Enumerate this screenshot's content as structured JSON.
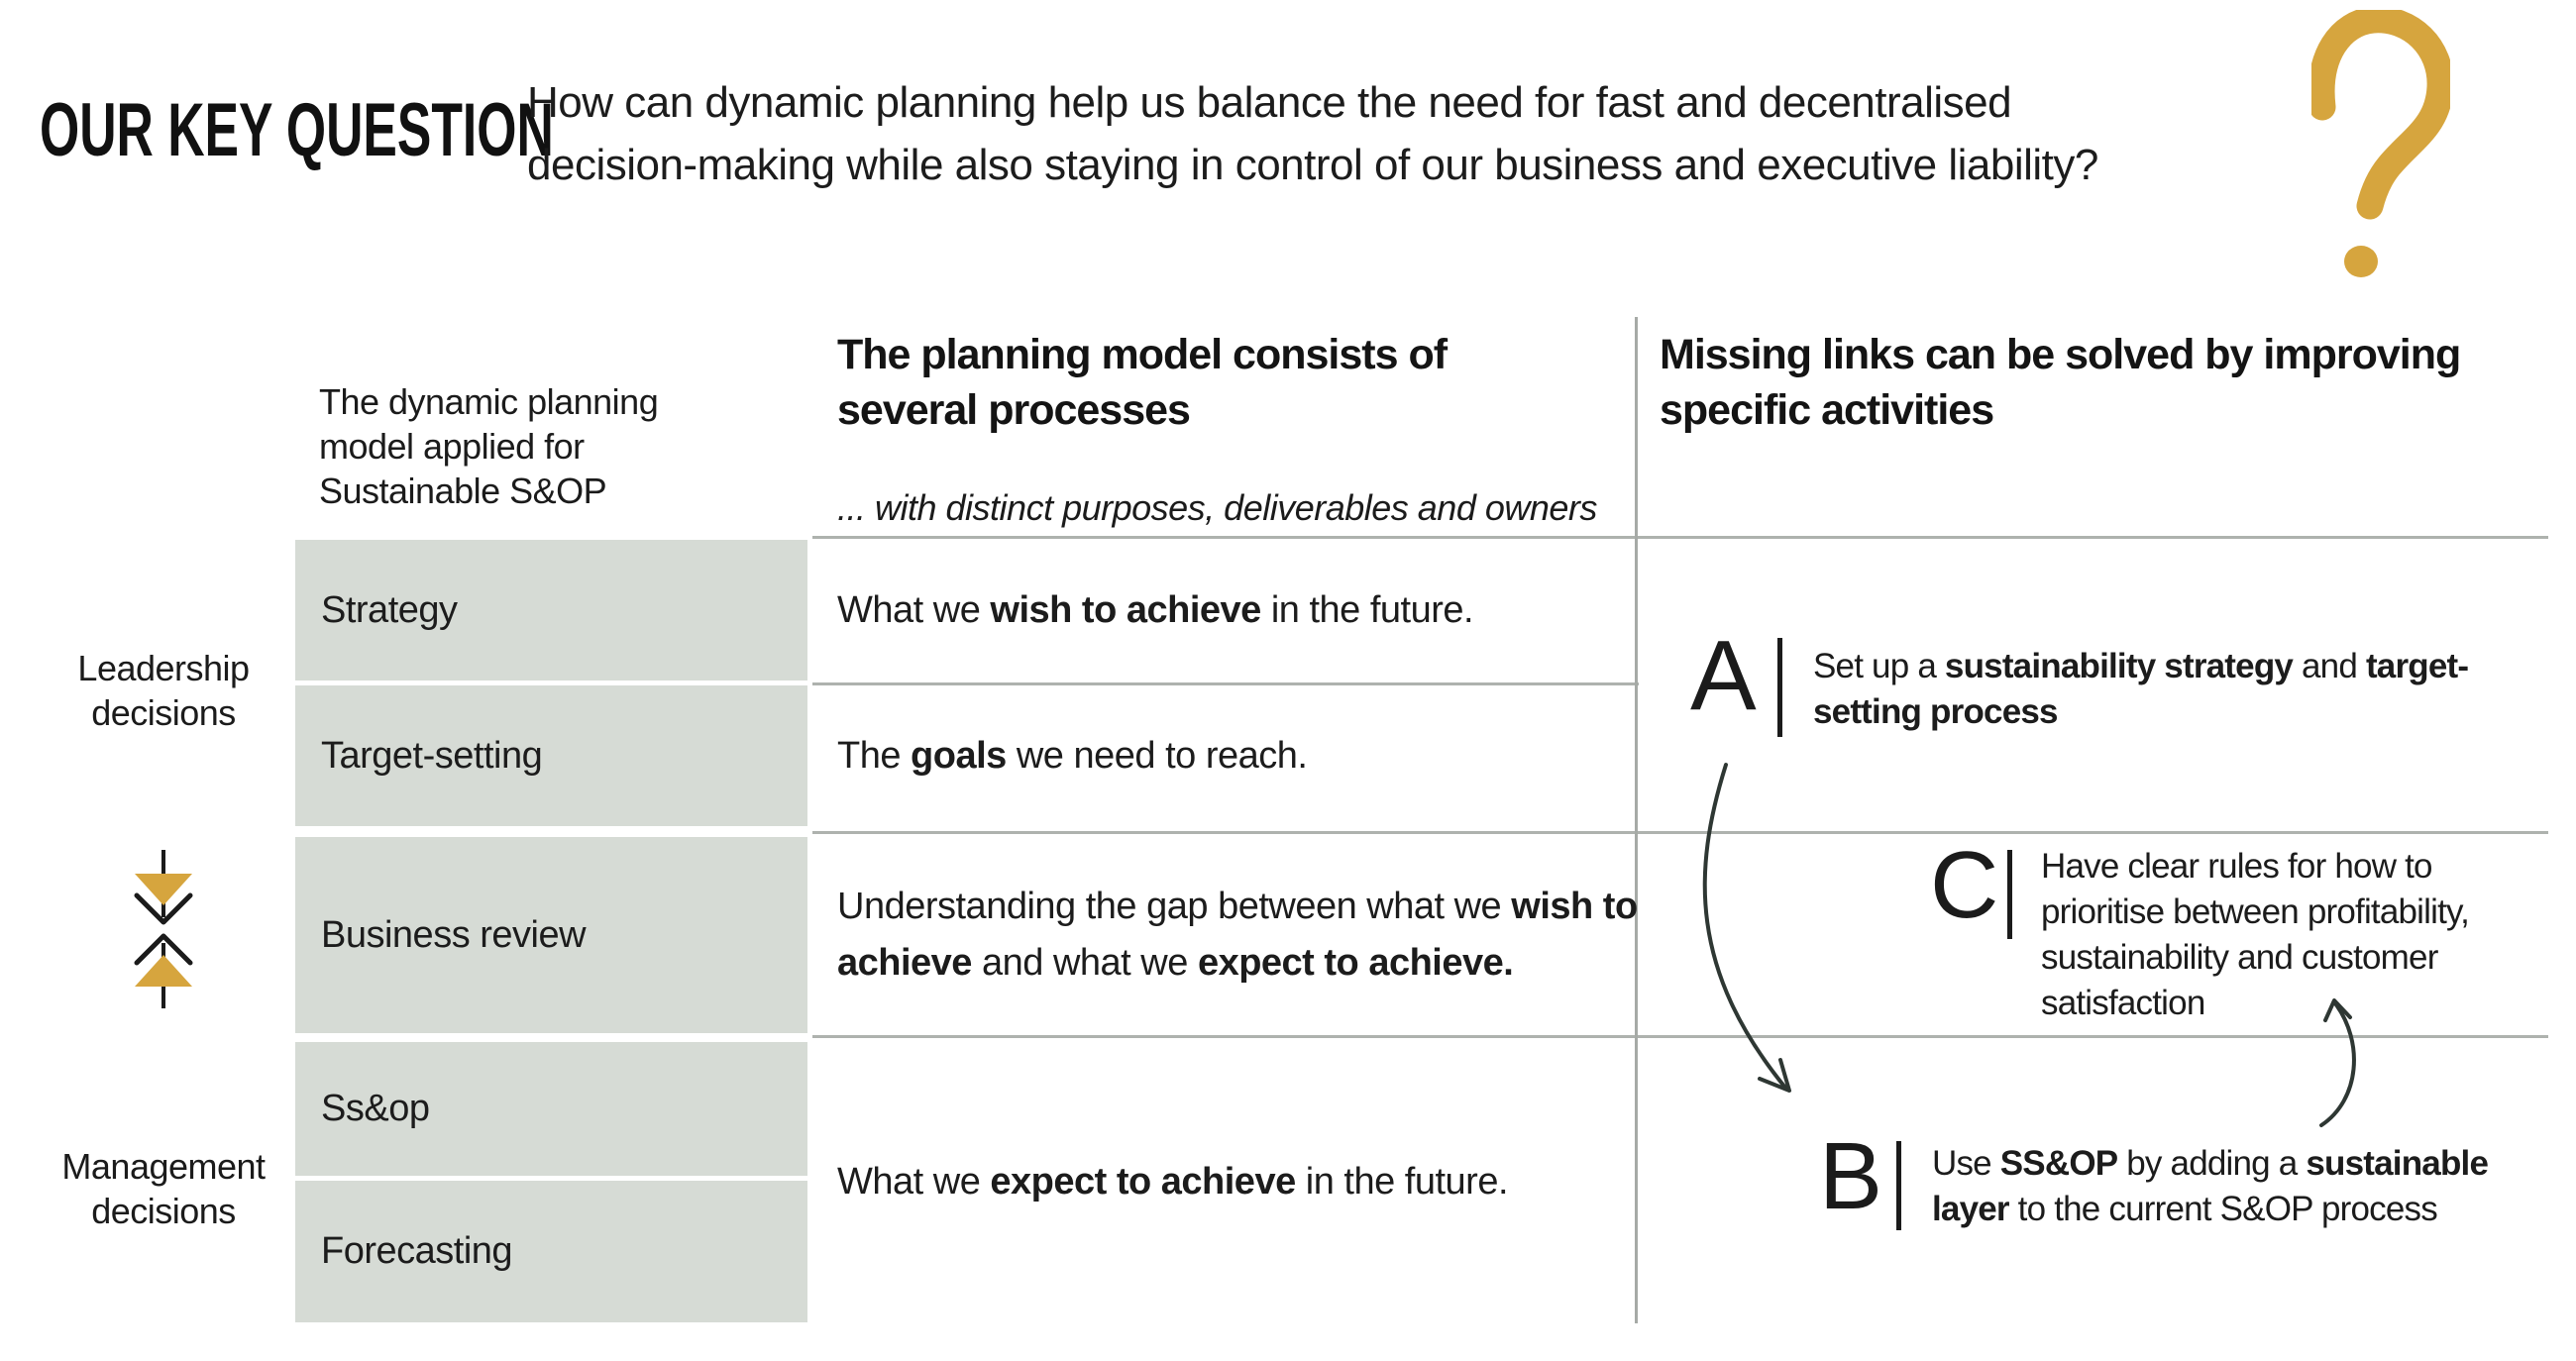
{
  "palette": {
    "accent_gold": "#D6A53E",
    "cell_gray": "#D6DBD5",
    "rule_gray": "#AEB2AE",
    "arrow_dark": "#2E3733",
    "text_dark": "#1B1B1B"
  },
  "icons": {
    "question_mark": "hand-drawn-question-mark",
    "leadership_management_flow": "bidirectional-vertical-arrows",
    "a_to_b": "curved-arrow-down",
    "b_to_c": "curved-arrow-up"
  },
  "header": {
    "kicker": "OUR KEY QUESTION",
    "question_lines": [
      "How can dynamic planning help us balance the need for fast and decentralised",
      "decision-making while also staying in control of our business and executive liability?"
    ]
  },
  "matrix": {
    "corner_header_lines": [
      "The dynamic planning",
      "model applied for",
      "Sustainable S&OP"
    ],
    "process_col": {
      "title_lines": [
        "The planning model consists of",
        "several processes"
      ],
      "subtitle": "... with distinct purposes, deliverables and owners"
    },
    "missing_links_col": {
      "title_lines": [
        "Missing links can be solved by improving",
        "specific activities"
      ]
    },
    "row_groups": [
      {
        "label": "Leadership decisions"
      },
      {
        "label": "Management decisions"
      }
    ],
    "rows": [
      {
        "name": "Strategy",
        "desc_lines": [
          [
            {
              "t": "What we "
            },
            {
              "t": "wish to achieve",
              "b": true
            },
            {
              "t": " in the future."
            }
          ]
        ]
      },
      {
        "name": "Target-setting",
        "desc_lines": [
          [
            {
              "t": "The "
            },
            {
              "t": "goals",
              "b": true
            },
            {
              "t": " we need to reach."
            }
          ]
        ]
      },
      {
        "name": "Business review",
        "desc_lines": [
          [
            {
              "t": "Understanding the gap between what we "
            },
            {
              "t": "wish to",
              "b": true
            }
          ],
          [
            {
              "t": "achieve",
              "b": true
            },
            {
              "t": " and what we "
            },
            {
              "t": "expect to achieve.",
              "b": true
            }
          ]
        ]
      },
      {
        "name": "Ss&op"
      },
      {
        "name": "Forecasting"
      }
    ],
    "merged_desc_lines": [
      [
        {
          "t": "What we "
        },
        {
          "t": "expect to achieve",
          "b": true
        },
        {
          "t": " in the future."
        }
      ]
    ]
  },
  "activities": [
    {
      "letter": "A",
      "lines": [
        [
          {
            "t": "Set up a "
          },
          {
            "t": "sustainability strategy",
            "b": true
          },
          {
            "t": " and "
          },
          {
            "t": "target-",
            "b": true
          }
        ],
        [
          {
            "t": "setting process",
            "b": true
          }
        ]
      ]
    },
    {
      "letter": "C",
      "lines": [
        [
          {
            "t": "Have clear rules for how to"
          }
        ],
        [
          {
            "t": "prioritise between profitability,"
          }
        ],
        [
          {
            "t": "sustainability and customer"
          }
        ],
        [
          {
            "t": "satisfaction"
          }
        ]
      ]
    },
    {
      "letter": "B",
      "lines": [
        [
          {
            "t": "Use "
          },
          {
            "t": "SS&OP",
            "b": true
          },
          {
            "t": " by adding a "
          },
          {
            "t": "sustainable",
            "b": true
          }
        ],
        [
          {
            "t": "layer",
            "b": true
          },
          {
            "t": " to the current S&OP process"
          }
        ]
      ]
    }
  ]
}
